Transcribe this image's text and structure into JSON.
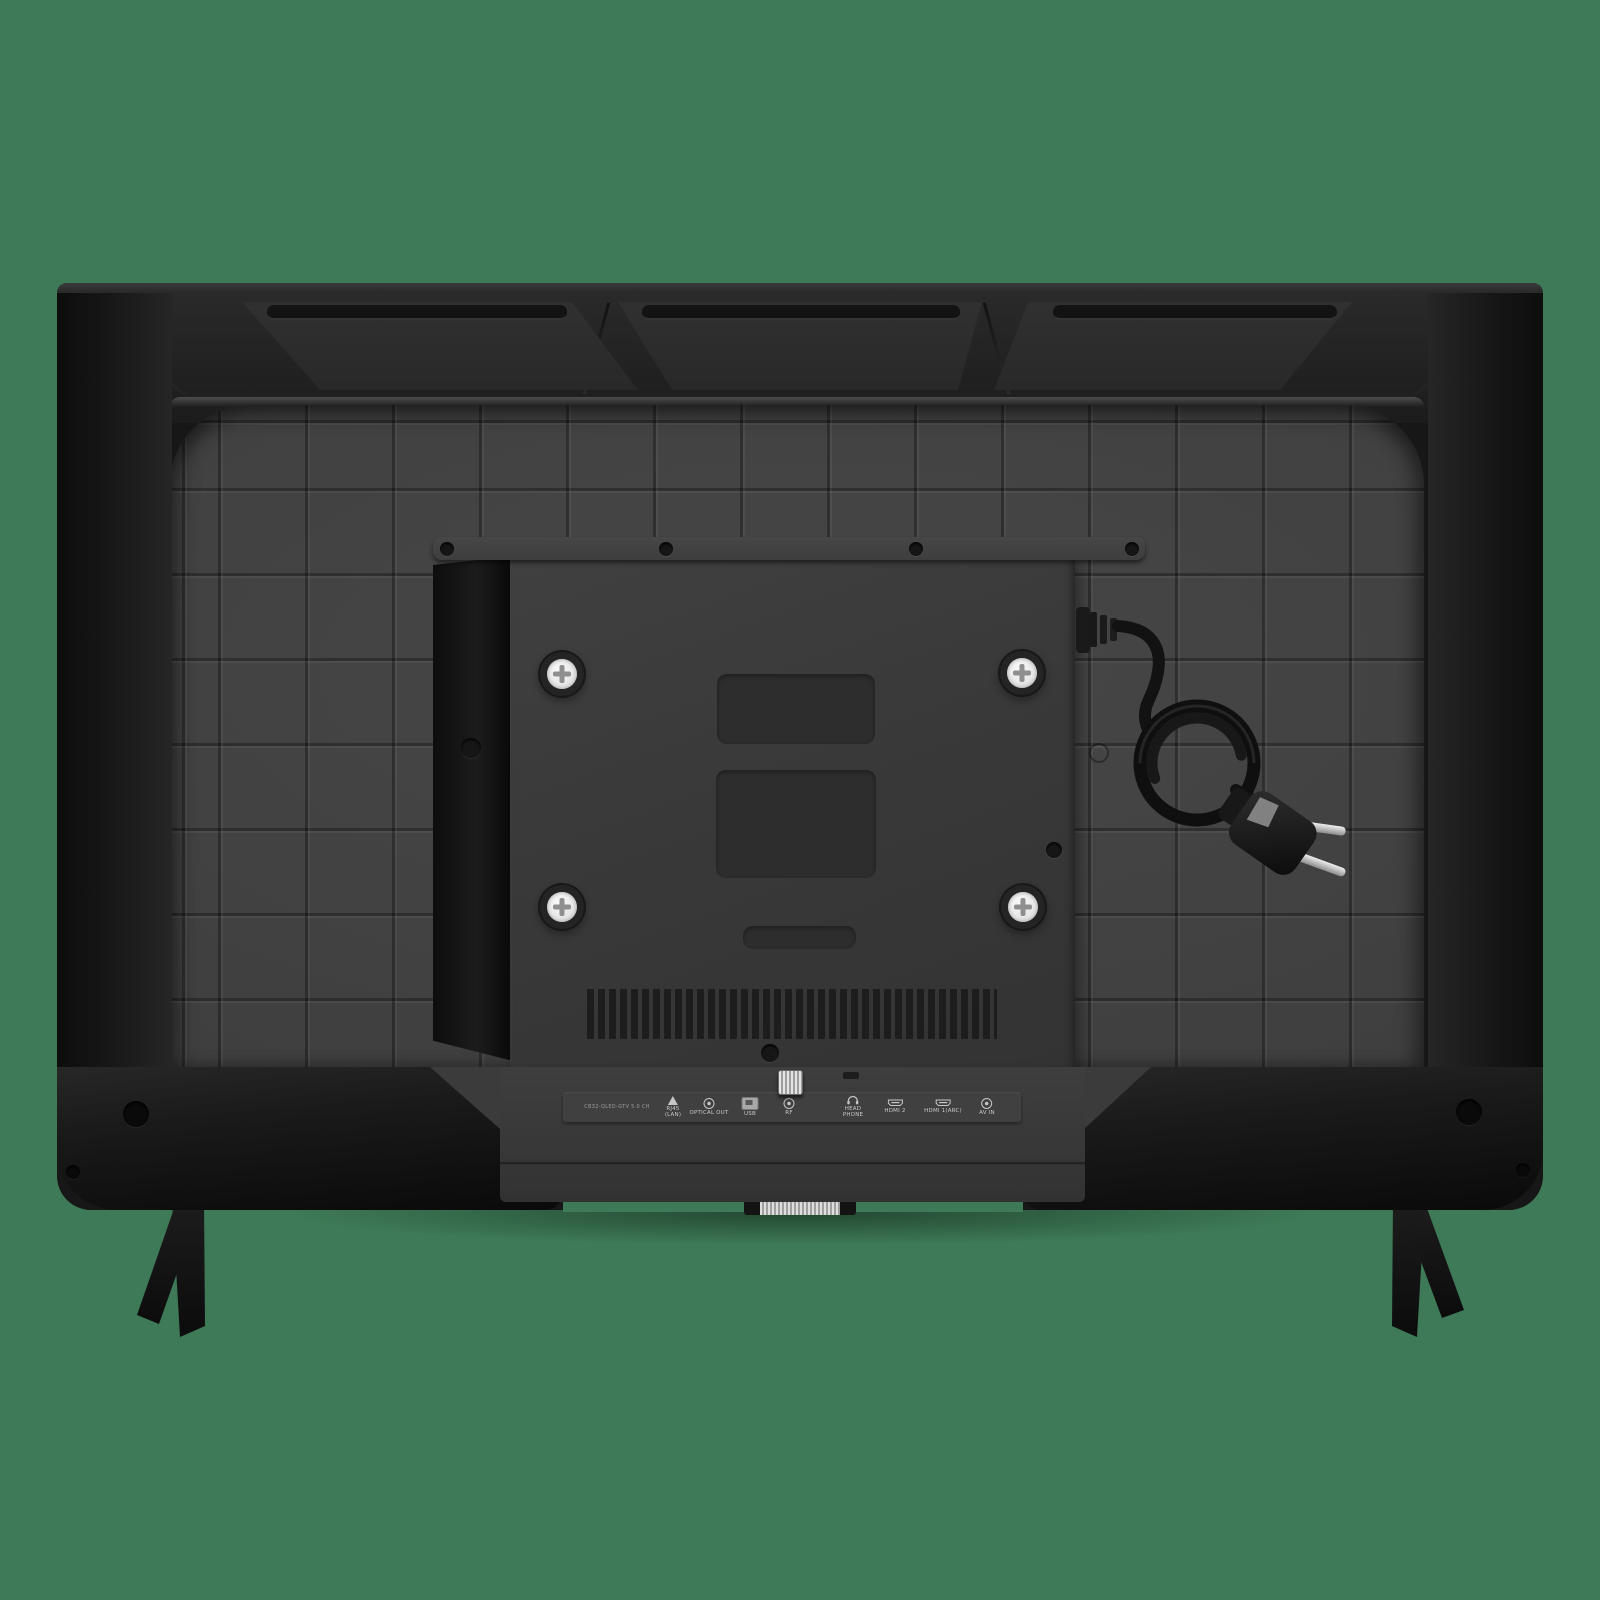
{
  "scene": {
    "description": "Rear view of a flat-screen television photographed on a plain green background",
    "background_color": "#3E7A57"
  },
  "tv": {
    "body_color": "#171717",
    "back_panel_color": "#424242",
    "mounting_plate_color": "#383838",
    "top_vent_count": 3,
    "vesa_screw_count": 4,
    "stand_leg_count": 2,
    "screw_color": "#EFEFEF",
    "power_plug_prong_color": "#D9D9D9"
  },
  "ports_strip": {
    "model_text": "CB32-QLED-GTV 5.0 CH",
    "label_color": "#C8C8C8",
    "ports": [
      {
        "icon": "lan-network-icon",
        "label": "RJ45\n(LAN)"
      },
      {
        "icon": "optical-out-icon",
        "label": "OPTICAL OUT"
      },
      {
        "icon": "usb-icon",
        "label": "USB"
      },
      {
        "icon": "rf-icon",
        "label": "RF"
      },
      {
        "icon": "headphone-icon",
        "label": "HEAD\nPHONE"
      },
      {
        "icon": "hdmi-icon",
        "label": "HDMI 2"
      },
      {
        "icon": "hdmi-icon",
        "label": "HDMI 1(ARC)"
      },
      {
        "icon": "av-in-icon",
        "label": "AV IN"
      }
    ]
  }
}
